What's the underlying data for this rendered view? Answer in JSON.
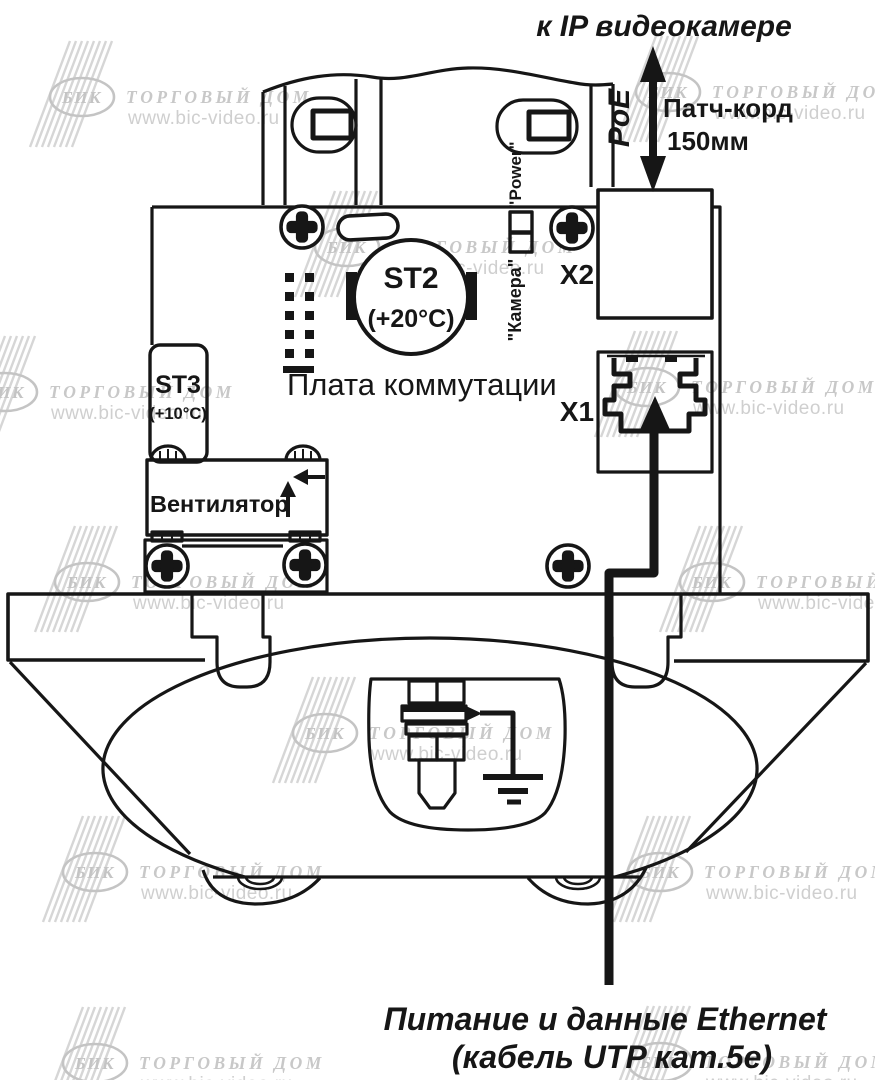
{
  "page": {
    "background": "#ffffff"
  },
  "colors": {
    "line": "#161616",
    "watermark_grey": "#c4c4c4",
    "watermark_light": "#d6d6d6"
  },
  "top": {
    "title": "к IP видеокамере",
    "poe": "PoE",
    "patch_cord_line1": "Патч-корд",
    "patch_cord_line2": "150мм"
  },
  "board": {
    "title": "Плата коммутации",
    "connector_x2": "X2",
    "connector_x1": "X1",
    "led_label_power": "\"Power\"",
    "led_label_camera": "\"Камера\"",
    "thermostat_st2": "ST2",
    "thermostat_st2_temp": "(+20°C)",
    "thermostat_st3": "ST3",
    "thermostat_st3_temp": "(+10°C)",
    "fan_label": "Вентилятор"
  },
  "bottom": {
    "caption_line1": "Питание и данные Ethernet",
    "caption_line2": "(кабель UTP кат.5е)"
  },
  "watermark": {
    "brand": "БИК",
    "company": "ТОРГОВЫЙ ДОМ",
    "site": "www.bic-video.ru"
  }
}
